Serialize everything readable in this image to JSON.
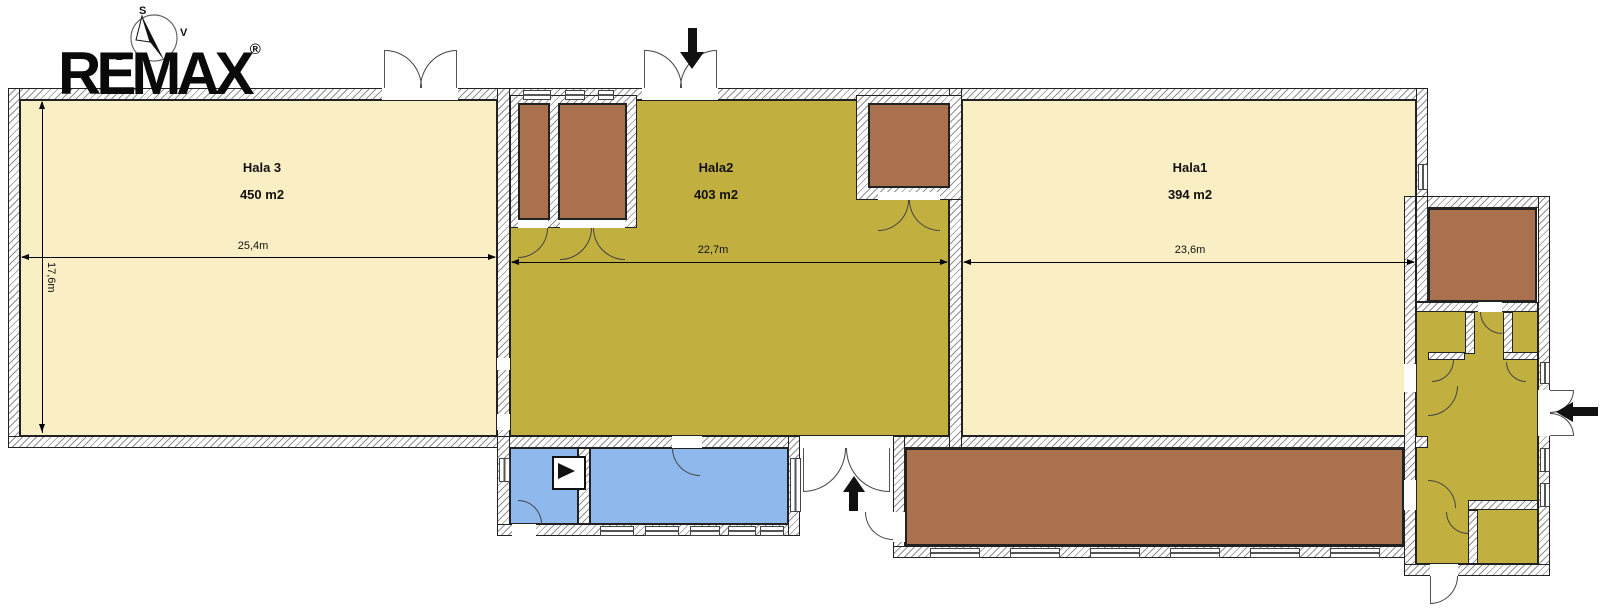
{
  "brand": {
    "logo_text": "REMAX",
    "registered_mark": "®"
  },
  "compass": {
    "north_label": "S",
    "east_label": "V",
    "west_label": "Z"
  },
  "rooms": {
    "hala3": {
      "name": "Hala 3",
      "area": "450 m2",
      "width": "25,4m",
      "depth": "17,6m"
    },
    "hala2": {
      "name": "Hala2",
      "area": "403 m2",
      "width": "22,7m"
    },
    "hala1": {
      "name": "Hala1",
      "area": "394 m2",
      "width": "23,6m"
    }
  },
  "colors": {
    "hall_light": "#FAEFC4",
    "hall_olive": "#C1AF3F",
    "room_brown": "#A9714E",
    "room_blue": "#8FB8EC",
    "wall_line": "#222222",
    "hatch_line": "#8f8f8f",
    "arrow_black": "#111111"
  }
}
